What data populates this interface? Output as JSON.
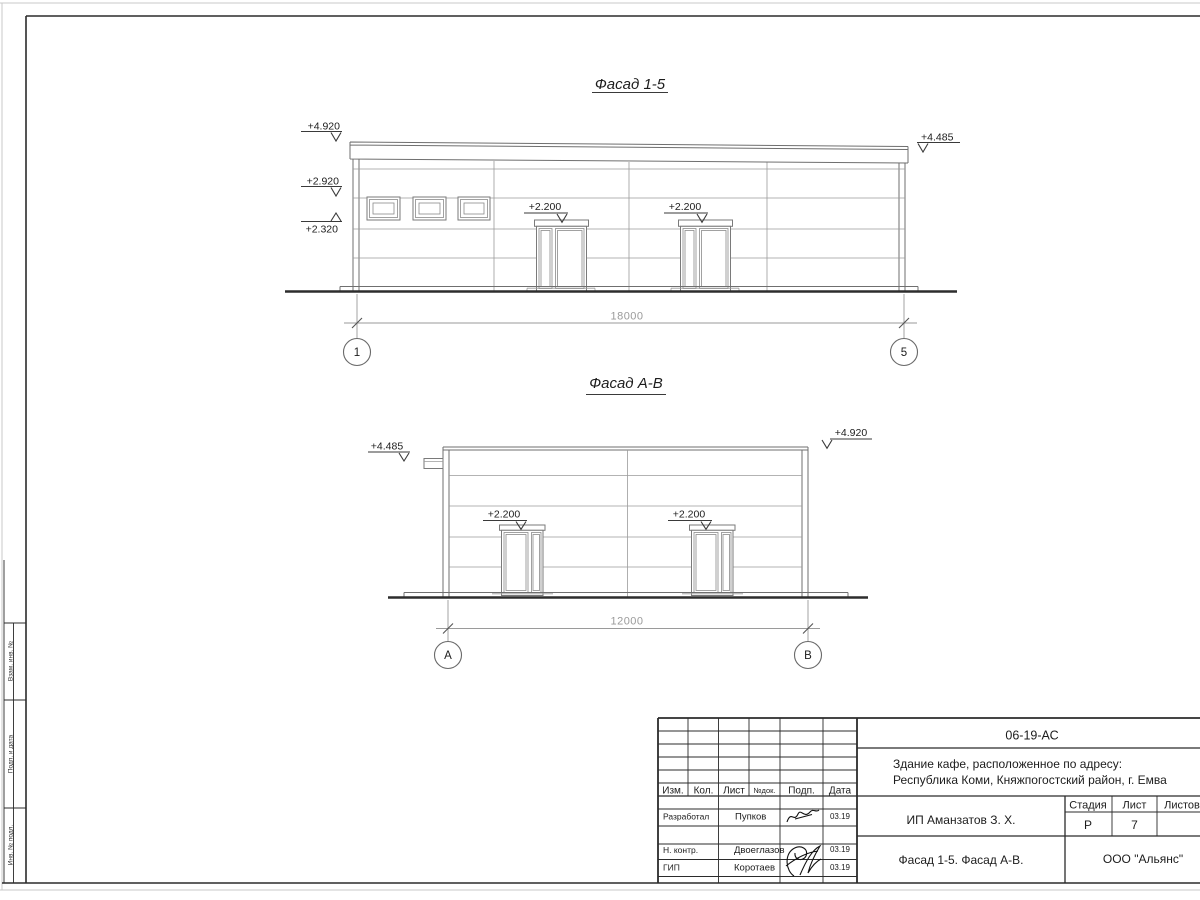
{
  "facade1": {
    "title": "Фасад 1-5",
    "mark_top_left": "+4.920",
    "mark_mid_left": "+2.920",
    "mark_low_left": "+2.320",
    "mark_top_right": "+4.485",
    "mark_door1": "+2.200",
    "mark_door2": "+2.200",
    "dimension": "18000",
    "axis_start": "1",
    "axis_end": "5"
  },
  "facade2": {
    "title": "Фасад А-В",
    "mark_top_left": "+4.485",
    "mark_top_right": "+4.920",
    "mark_door1": "+2.200",
    "mark_door2": "+2.200",
    "dimension": "12000",
    "axis_start": "А",
    "axis_end": "В"
  },
  "margin_labels": [
    "Взам. инв. №",
    "Подп. и дата",
    "Инв. № подл."
  ],
  "title_block": {
    "doc_number": "06-19-АС",
    "project_address_line1": "Здание кафе, расположенное по адресу:",
    "project_address_line2": "Республика Коми, Княжпогостский район, г. Емва",
    "columns": {
      "izm": "Изм.",
      "kol": "Кол.",
      "list": "Лист",
      "ndok": "№док.",
      "podp": "Подп.",
      "data": "Дата"
    },
    "rows": [
      {
        "role": "Разработал",
        "name": "Пупков",
        "date": "03.19"
      },
      {
        "role": "Н. контр.",
        "name": "Двоеглазов",
        "date": "03.19"
      },
      {
        "role": "ГИП",
        "name": "Коротаев",
        "date": "03.19"
      }
    ],
    "client": "ИП Аманзатов З. Х.",
    "stage_label": "Стадия",
    "sheet_label": "Лист",
    "sheets_label": "Листов",
    "stage": "Р",
    "sheet_number": "7",
    "drawing_title": "Фасад 1-5. Фасад А-В.",
    "company": "ООО \"Альянс\""
  }
}
